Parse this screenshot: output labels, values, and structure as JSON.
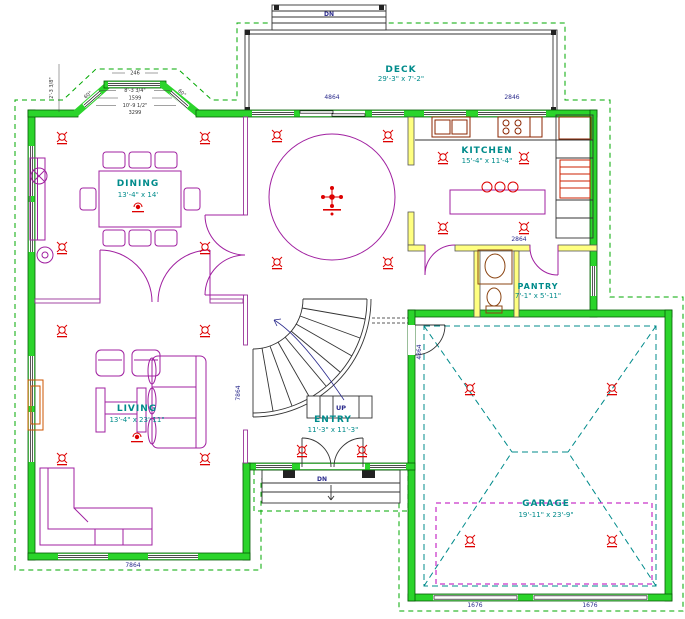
{
  "rooms": {
    "deck": {
      "name": "DECK",
      "dims": "29'-3\" x 7'-2\""
    },
    "dining": {
      "name": "DINING",
      "dims": "13'-4\" x 14'"
    },
    "kitchen": {
      "name": "KITCHEN",
      "dims": "15'-4\" x 11'-4\""
    },
    "pantry": {
      "name": "PANTRY",
      "dims": "7'-1\" x 5'-11\""
    },
    "living": {
      "name": "LIVING",
      "dims": "13'-4\" x 23'-11\""
    },
    "entry": {
      "name": "ENTRY",
      "dims": "11'-3\" x 11'-3\""
    },
    "garage": {
      "name": "GARAGE",
      "dims": "19'-11\" x 23'-9\""
    }
  },
  "stair_labels": {
    "up": "UP",
    "deck_down": "DN",
    "porch_down": "DN"
  },
  "wall_labels": {
    "deck_door": "4864",
    "kitchen_window": "2846",
    "hall_left": "7864",
    "hall_right": "4864",
    "pantry_top": "2864",
    "garage_door_1": "1676",
    "garage_door_2": "1676",
    "living_bottom": "7864"
  },
  "bay_dims": {
    "d1": "246",
    "d2": "8'-3 3/4\"",
    "d3": "1599",
    "d4": "10'-9 1/2\"",
    "d5": "3299",
    "angle_left": "60°",
    "angle_right": "60°",
    "side": "2'-3 3/8\""
  },
  "colors": {
    "exterior_wall": "#2bd42b",
    "roof_overhang": "#00a800",
    "room_label": "#008b8b",
    "furniture": "#a020a0",
    "light_symbol": "#dd0000",
    "dim_text": "#2a2a8c",
    "interior_wall": "#ffff80",
    "attic_line": "#bb00bb"
  },
  "lights": [
    [
      62,
      137
    ],
    [
      205,
      137
    ],
    [
      62,
      247
    ],
    [
      205,
      247
    ],
    [
      277,
      135
    ],
    [
      388,
      135
    ],
    [
      277,
      262
    ],
    [
      388,
      262
    ],
    [
      443,
      157
    ],
    [
      524,
      157
    ],
    [
      443,
      227
    ],
    [
      524,
      227
    ],
    [
      302,
      450
    ],
    [
      362,
      450
    ],
    [
      62,
      330
    ],
    [
      205,
      330
    ],
    [
      62,
      458
    ],
    [
      205,
      458
    ],
    [
      470,
      388
    ],
    [
      612,
      388
    ],
    [
      470,
      540
    ],
    [
      612,
      540
    ]
  ],
  "symbols": [
    {
      "ref": "chandelier",
      "x": 332,
      "y": 197
    },
    {
      "ref": "fan",
      "x": 138,
      "y": 207
    },
    {
      "ref": "fan",
      "x": 137,
      "y": 437
    }
  ]
}
